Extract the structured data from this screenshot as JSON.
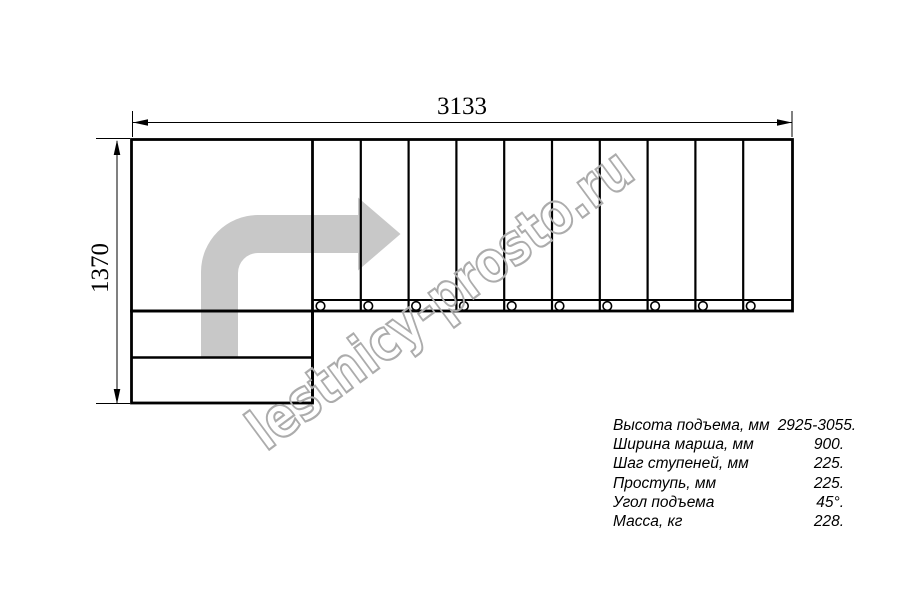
{
  "title": "L-shaped staircase plan drawing",
  "watermark": {
    "text": "lestnicy-prosto.ru"
  },
  "dimensions": {
    "width_mm": "3133",
    "height_mm": "1370"
  },
  "plan": {
    "straight_treads_count": 10,
    "lower_winder_steps_count": 2,
    "direction_arrow": "up-then-right"
  },
  "specs": {
    "rows": [
      {
        "label": "Высота подъема, мм",
        "value": "2925-3055."
      },
      {
        "label": "Ширина марша, мм",
        "value": "900."
      },
      {
        "label": "Шаг ступеней, мм",
        "value": "225."
      },
      {
        "label": "Проступь, мм",
        "value": "225."
      },
      {
        "label": "Угол подъема",
        "value": "45°."
      },
      {
        "label": "Масса, кг",
        "value": "228."
      }
    ]
  },
  "colors": {
    "line": "#000000",
    "direction_arrow_fill": "#c8c8c8",
    "watermark_stroke": "#acacac"
  }
}
